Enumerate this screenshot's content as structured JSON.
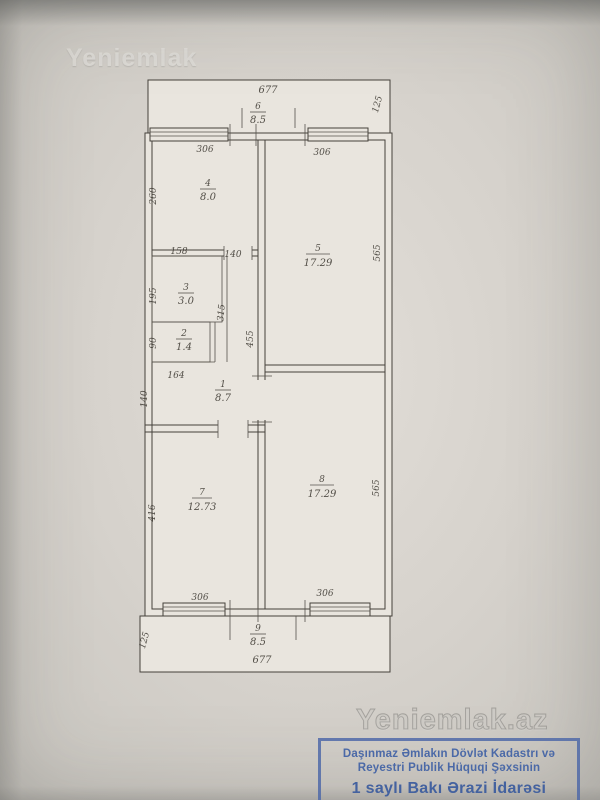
{
  "watermarks": {
    "top": "Yeniemlak",
    "bottom": "Yeniemlak.az"
  },
  "plan": {
    "balcony_top": {
      "number": "6",
      "area": "8.5",
      "width": "677",
      "depth": "125"
    },
    "balcony_bottom": {
      "number": "9",
      "area": "8.5",
      "width": "677",
      "depth": "125"
    },
    "rooms": {
      "r1": {
        "number": "1",
        "area": "8.7"
      },
      "r2": {
        "number": "2",
        "area": "1.4",
        "height": "90",
        "width": "164"
      },
      "r3": {
        "number": "3",
        "area": "3.0",
        "width": "158",
        "height": "195",
        "right": "315"
      },
      "r4": {
        "number": "4",
        "area": "8.0",
        "width": "306",
        "height": "260"
      },
      "r5": {
        "number": "5",
        "area": "17.29",
        "width": "306",
        "height": "565"
      },
      "r7": {
        "number": "7",
        "area": "12.73",
        "width": "306",
        "height": "416"
      },
      "r8": {
        "number": "8",
        "area": "17.29",
        "width": "306",
        "height": "565"
      }
    },
    "extra_dims": {
      "door_top": "140",
      "wall_left": "140",
      "corridor_right": "455"
    }
  },
  "stamp": {
    "line1": "Daşınmaz Əmlakın Dövlət Kadastrı və",
    "line2": "Reyestri Publik Hüquqi Şəxsinin",
    "line3": "1 saylı Bakı Ərazi İdarəsi"
  }
}
